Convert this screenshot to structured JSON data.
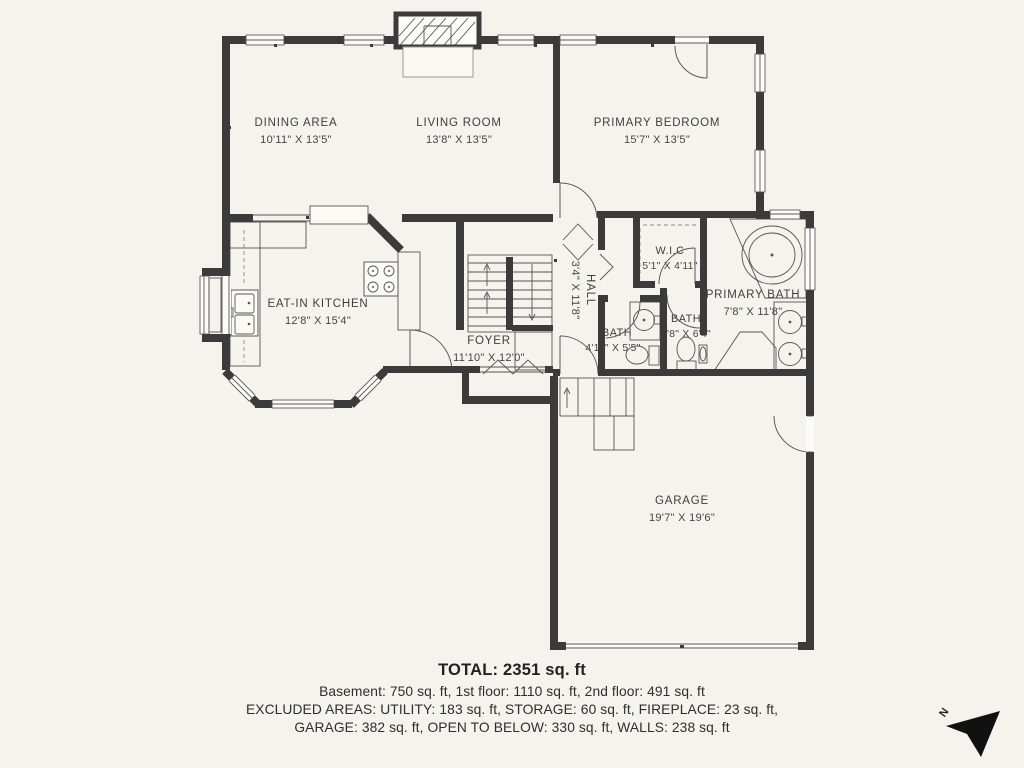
{
  "rooms": [
    {
      "name": "DINING AREA",
      "dims": "10'11\" X 13'5\""
    },
    {
      "name": "LIVING ROOM",
      "dims": "13'8\" X 13'5\""
    },
    {
      "name": "PRIMARY BEDROOM",
      "dims": "15'7\" X 13'5\""
    },
    {
      "name": "EAT-IN KITCHEN",
      "dims": "12'8\" X 15'4\""
    },
    {
      "name": "FOYER",
      "dims": "11'10\" X 12'0\""
    },
    {
      "name": "HALL",
      "dims": "3'4\" X 11'8\""
    },
    {
      "name": "W.I.C",
      "dims": "5'1\" X 4'11\""
    },
    {
      "name": "PRIMARY BATH",
      "dims": "7'8\" X 11'8\""
    },
    {
      "name": "BATH",
      "dims": "4'11\" X 5'5\""
    },
    {
      "name": "BATH",
      "dims": "4'8\" X 6'4\""
    },
    {
      "name": "GARAGE",
      "dims": "19'7\" X 19'6\""
    }
  ],
  "footer": {
    "total": "TOTAL: 2351 sq. ft",
    "line1": "Basement: 750 sq. ft, 1st floor: 1110 sq. ft, 2nd floor: 491 sq. ft",
    "line2": "EXCLUDED AREAS: UTILITY: 183 sq. ft, STORAGE: 60 sq. ft, FIREPLACE: 23 sq. ft,",
    "line3": "GARAGE: 382 sq. ft, OPEN TO BELOW: 330 sq. ft, WALLS: 238 sq. ft"
  },
  "compass": {
    "label": "N"
  },
  "colors": {
    "background": "#f4f3ed",
    "walls": "#3b3b3b",
    "lines": "#555555",
    "text": "#3f3f3f"
  }
}
